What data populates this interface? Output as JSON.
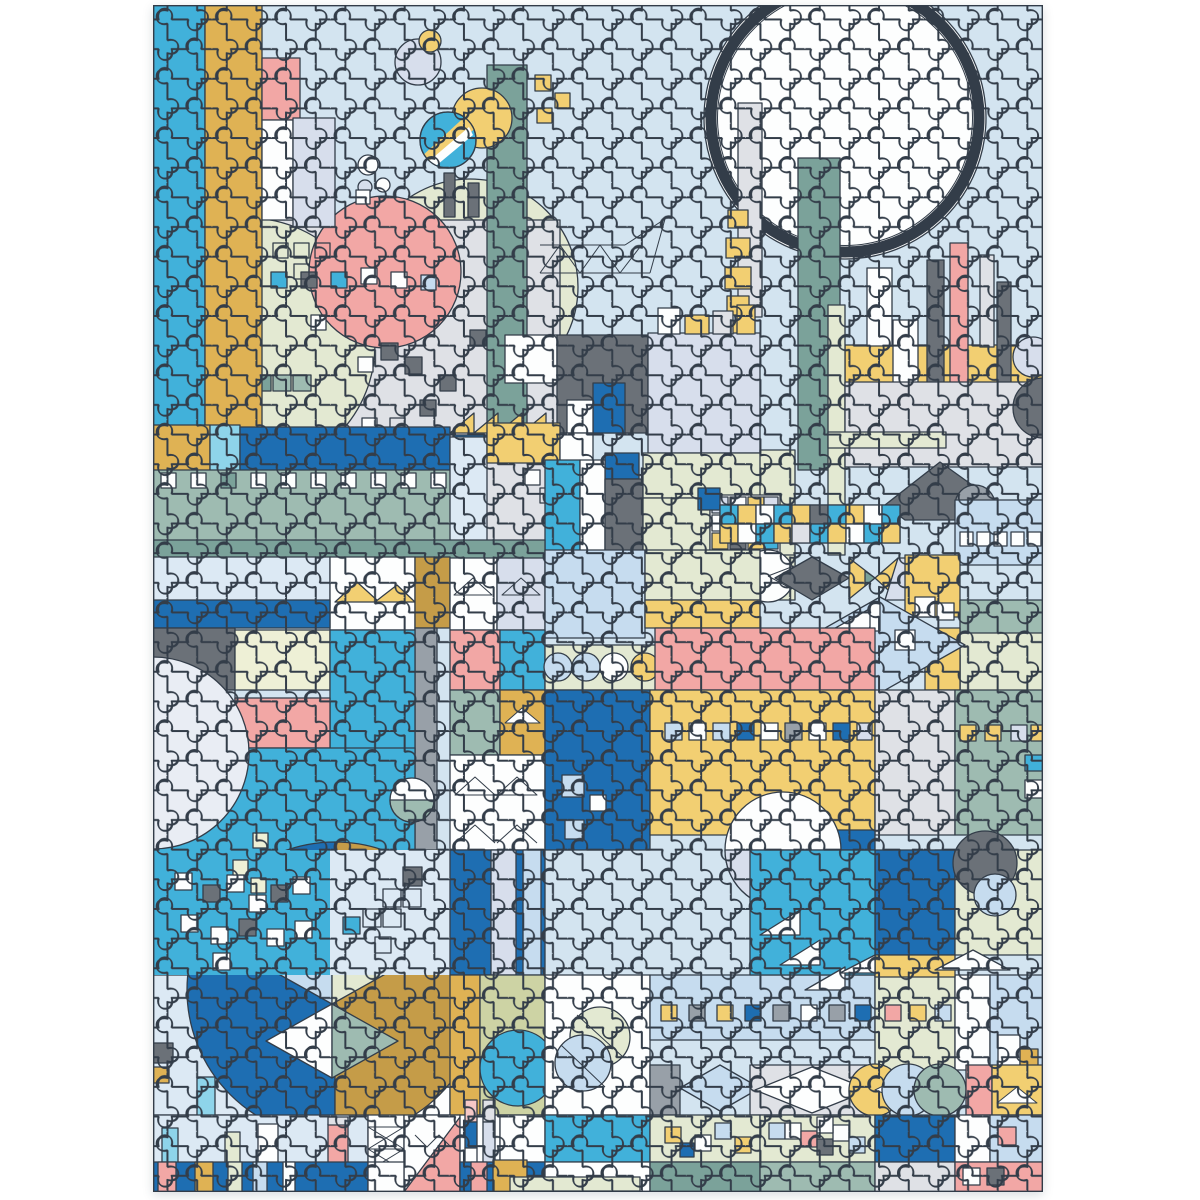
{
  "meta": {
    "title": "Completed 1000-piece jigsaw puzzle — abstract geometric pastel cityscape artwork",
    "domain_note": "product photo on white background"
  },
  "scene": {
    "description": "A fully assembled rectangular jigsaw puzzle photographed on a white background. The artwork is an abstract geometric city in pastel tones: a large gold-ringed white sun over a light blue sky, cyan and gold columns, pink and teal towers, a gray collage panel scattered with tiny squares, Mondrian-style machine blocks, checkerboard bands, diamond windows, rows of small squares, a trio of circles, and a large half-circle bowl split into deep blue and ochre halves with chevron triangles near the bottom left. Subtle embossed puzzle-piece cut lines cover the entire image.",
    "motifs": [
      "sun-ring",
      "sky",
      "cyan-column",
      "gold-column",
      "pink-tower",
      "teal-tower",
      "crane-truss",
      "collage-panel",
      "pink-circle",
      "pale-green-circles",
      "scattered-squares",
      "mondrian-machine",
      "checkerboard-band",
      "gray-cap",
      "diamond-window",
      "circle-quartet",
      "chevron-houses",
      "gold-square-rows",
      "lavender-circle",
      "blue-ochre-bowl",
      "circle-trio",
      "striped-bottom-bands"
    ]
  },
  "palette": {
    "page": "#ffffff",
    "sky": "#d3e4f0",
    "cyan": "#41b1da",
    "cyanLight": "#8ed4ea",
    "deepBlue": "#1e6eb2",
    "lightBlue": "#c6dcef",
    "paleBlue": "#dce9f4",
    "gold": "#f2cf72",
    "ringGold": "#f3da8c",
    "mustard": "#dfb254",
    "darkMustard": "#c59c48",
    "cream": "#eef0d6",
    "pink": "#f2a7a5",
    "palePink": "#f6c8c6",
    "sage": "#9ebbb1",
    "teal": "#7ba29a",
    "paleGreen": "#e3e9d2",
    "olive": "#cdd3a4",
    "lavender": "#d7deec",
    "lavLight": "#e9edf4",
    "lightGray": "#dfe1e6",
    "midGray": "#98a0a8",
    "darkGray": "#6b7178",
    "white": "#fdfefe",
    "line": "#333d49"
  }
}
